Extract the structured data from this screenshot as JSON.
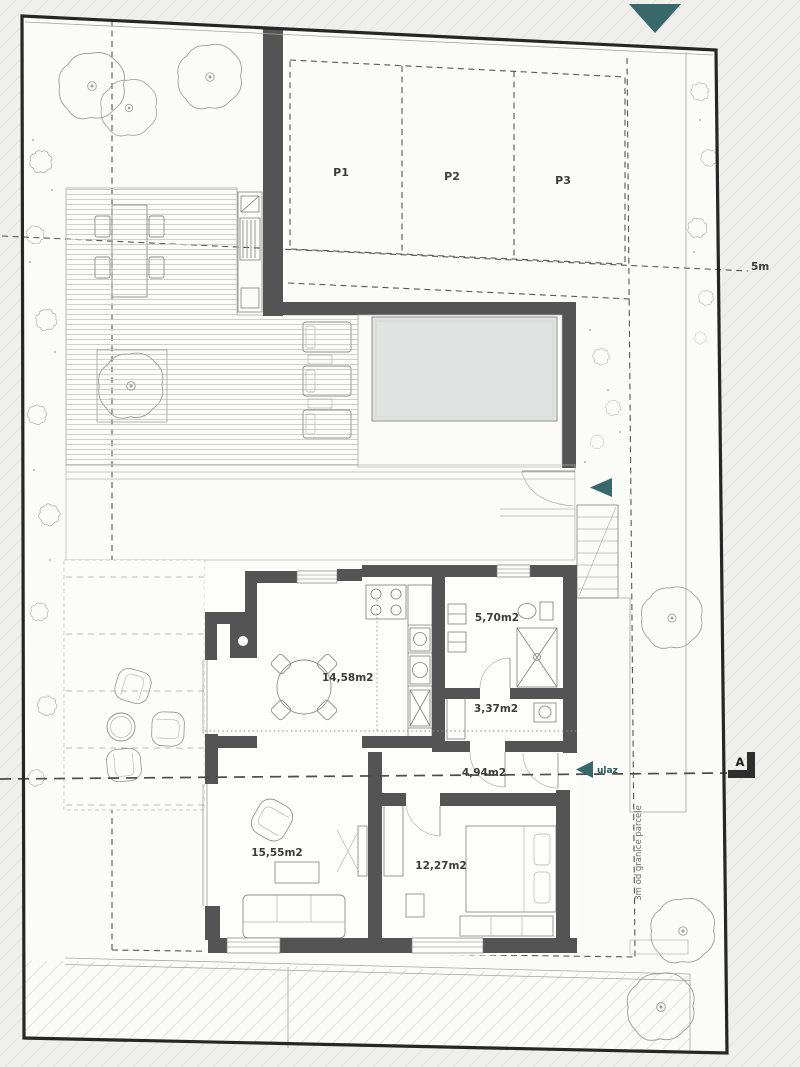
{
  "plan": {
    "parking": {
      "stalls": [
        "P1",
        "P2",
        "P3"
      ]
    },
    "rooms": {
      "dining_kitchen": "14,58m2",
      "bathroom": "5,70m2",
      "wc": "3,37m2",
      "hallway": "4,94m2",
      "living_room": "15,55m2",
      "bedroom": "12,27m2"
    },
    "annotations": {
      "entrance": "ulaz",
      "setback": "3m od granice parcele",
      "distance": "5m",
      "section": "A"
    },
    "colors": {
      "teal": "#38686a",
      "wall": "#545454",
      "pool": "#e1e3e2"
    }
  }
}
